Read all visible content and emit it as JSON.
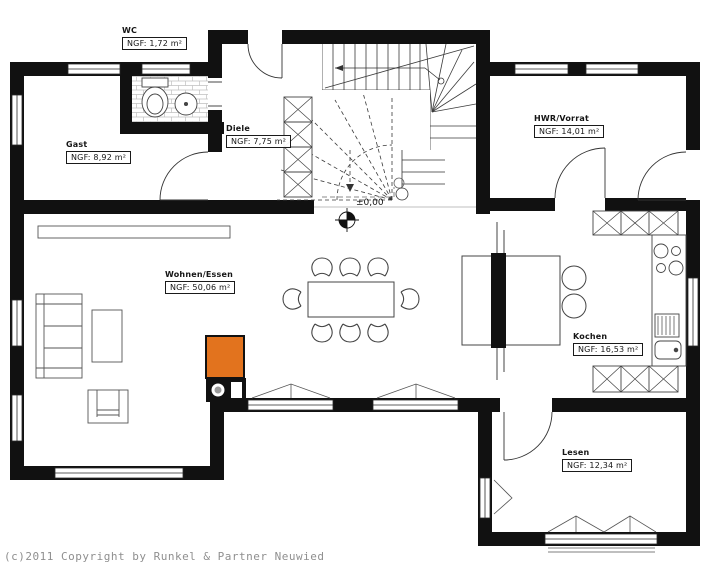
{
  "meta": {
    "copyright": "(c)2011 Copyright by Runkel & Partner Neuwied"
  },
  "level_marker": {
    "label": "±0,00"
  },
  "rooms": [
    {
      "id": "wc",
      "name": "WC",
      "area": "NGF: 1,72 m²"
    },
    {
      "id": "gast",
      "name": "Gast",
      "area": "NGF: 8,92 m²"
    },
    {
      "id": "diele",
      "name": "Diele",
      "area": "NGF: 7,75 m²"
    },
    {
      "id": "hwr",
      "name": "HWR/Vorrat",
      "area": "NGF: 14,01 m²"
    },
    {
      "id": "wohnen",
      "name": "Wohnen/Essen",
      "area": "NGF: 50,06 m²"
    },
    {
      "id": "kochen",
      "name": "Kochen",
      "area": "NGF: 16,53 m²"
    },
    {
      "id": "lesen",
      "name": "Lesen",
      "area": "NGF: 12,34 m²"
    }
  ],
  "colors": {
    "wall": "#111111",
    "stove_accent": "#e2731e",
    "furniture_line": "#555555",
    "copyright_text": "#8f8f8f"
  }
}
